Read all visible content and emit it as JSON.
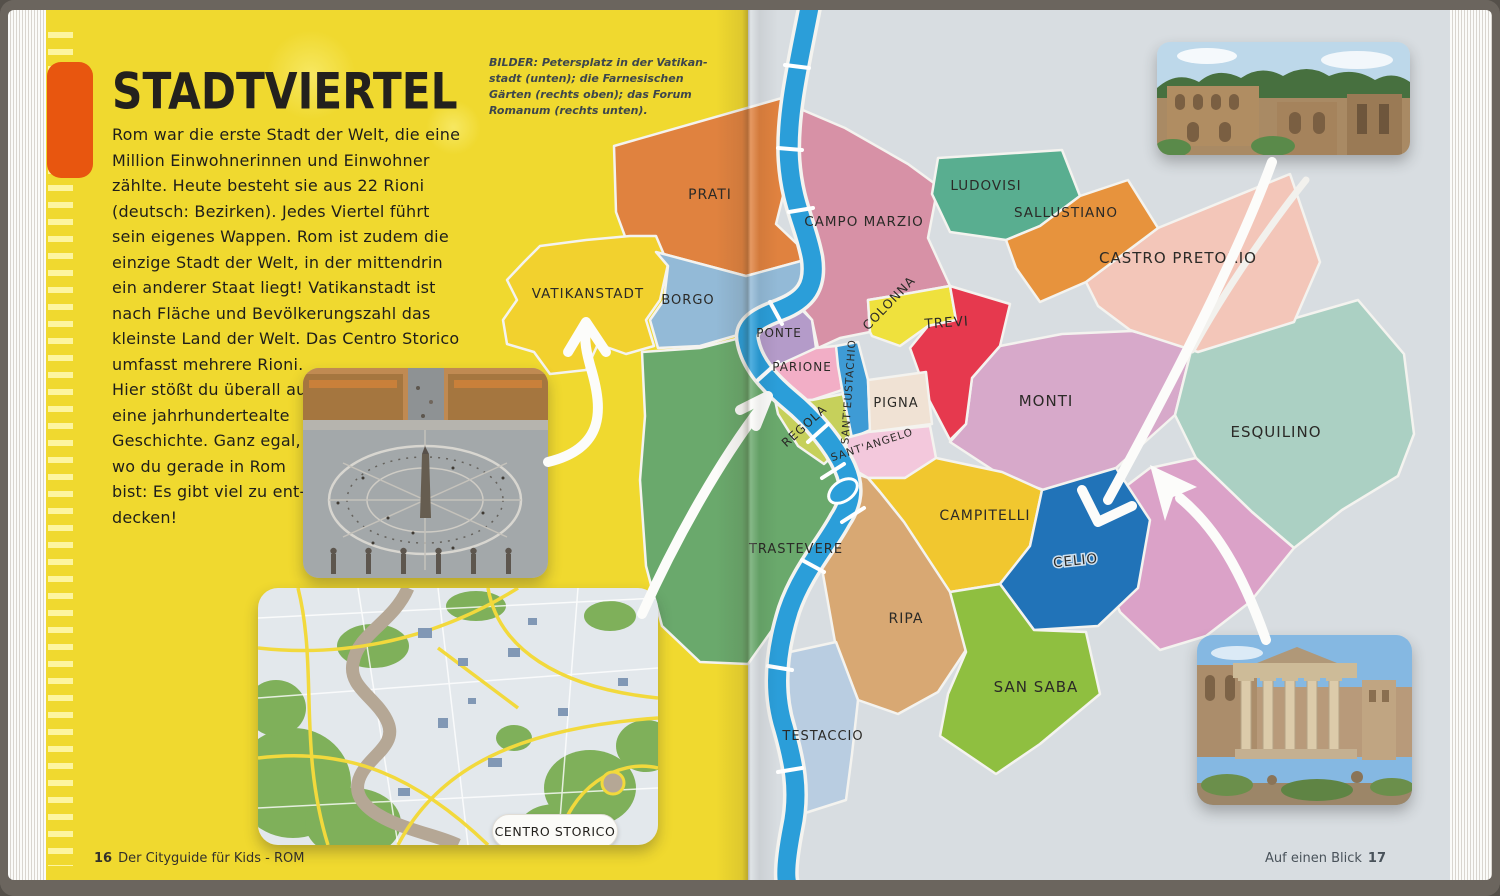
{
  "book": {
    "left_page": {
      "title": "STADTVIERTEL",
      "body_lines": [
        "Rom war die erste Stadt der Welt, die eine",
        "Million Einwohnerinnen und Einwohner",
        "zählte. Heute besteht sie aus 22 Rioni",
        "(deutsch: Bezirken). Jedes Viertel führt",
        "sein eigenes Wappen. Rom ist zudem die",
        "einzige Stadt der Welt, in der mittendrin",
        "ein anderer Staat liegt! Vatikanstadt ist",
        "nach Fläche und Bevölkerungszahl das",
        "kleinste Land der Welt. Das Centro Storico",
        "umfasst mehrere Rioni.",
        "Hier stößt du überall auf",
        "eine jahrhundertealte",
        "Geschichte. Ganz egal,",
        "wo du gerade in Rom",
        "bist: Es gibt viel zu ent-",
        "decken!"
      ],
      "caption_lines": [
        "BILDER: Petersplatz in der Vatikan-",
        "stadt (unten); die Farnesischen",
        "Gärten (rechts oben); das Forum",
        "Romanum (rechts unten)."
      ],
      "footer": {
        "page_number": "16",
        "text": "Der Cityguide für Kids - ROM"
      }
    },
    "right_page": {
      "footer": {
        "text": "Auf einen Blick",
        "page_number": "17"
      }
    }
  },
  "map": {
    "callout_label": "CENTRO STORICO",
    "river_color": "#2b9ed9",
    "districts": [
      {
        "id": "campo_marzio",
        "name": "CAMPO MARZIO",
        "color": "#d791a6"
      },
      {
        "id": "prati",
        "name": "PRATI",
        "color": "#e0823f"
      },
      {
        "id": "vatikanstadt",
        "name": "VATIKANSTADT",
        "color": "#f2d12e"
      },
      {
        "id": "borgo",
        "name": "BORGO",
        "color": "#93bad7"
      },
      {
        "id": "trastevere",
        "name": "TRASTEVERE",
        "color": "#6aa96c"
      },
      {
        "id": "monti",
        "name": "MONTI",
        "color": "#d7a9ca"
      },
      {
        "id": "esquilino",
        "name": "ESQUILINO",
        "color": "#abd0c3"
      },
      {
        "id": "se_pink_area",
        "name": "",
        "color": "#dba2c8"
      },
      {
        "id": "castro_pretorio",
        "name": "CASTRO PRETORIO",
        "color": "#f3c6b9"
      },
      {
        "id": "ludovisi",
        "name": "LUDOVISI",
        "color": "#59ae90"
      },
      {
        "id": "sallustiano",
        "name": "SALLUSTIANO",
        "color": "#e7933d"
      },
      {
        "id": "colonna",
        "name": "COLONNA",
        "color": "#efe13d"
      },
      {
        "id": "trevi",
        "name": "TREVI",
        "color": "#e6394e"
      },
      {
        "id": "ponte",
        "name": "PONTE",
        "color": "#b49bc9"
      },
      {
        "id": "parione",
        "name": "PARIONE",
        "color": "#f2aec6"
      },
      {
        "id": "regola",
        "name": "REGOLA",
        "color": "#c6d05b"
      },
      {
        "id": "sant_eustachio",
        "name": "SANT'EUSTACHIO",
        "color": "#3e9bd5"
      },
      {
        "id": "pigna",
        "name": "PIGNA",
        "color": "#f0e2d4"
      },
      {
        "id": "sant_angelo",
        "name": "SANT'ANGELO",
        "color": "#f3c8dc"
      },
      {
        "id": "campitelli",
        "name": "CAMPITELLI",
        "color": "#f1c72f"
      },
      {
        "id": "celio",
        "name": "CELIO",
        "color": "#2173b8"
      },
      {
        "id": "ripa",
        "name": "RIPA",
        "color": "#d8a873"
      },
      {
        "id": "san_saba",
        "name": "SAN SABA",
        "color": "#8fbf40"
      },
      {
        "id": "testaccio",
        "name": "TESTACCIO",
        "color": "#b9cde1"
      }
    ]
  },
  "colors": {
    "left_page_bg": "#f0d92f",
    "right_page_bg": "#d8dde1",
    "tab_orange": "#e8560f",
    "cover": "#6b655e"
  }
}
